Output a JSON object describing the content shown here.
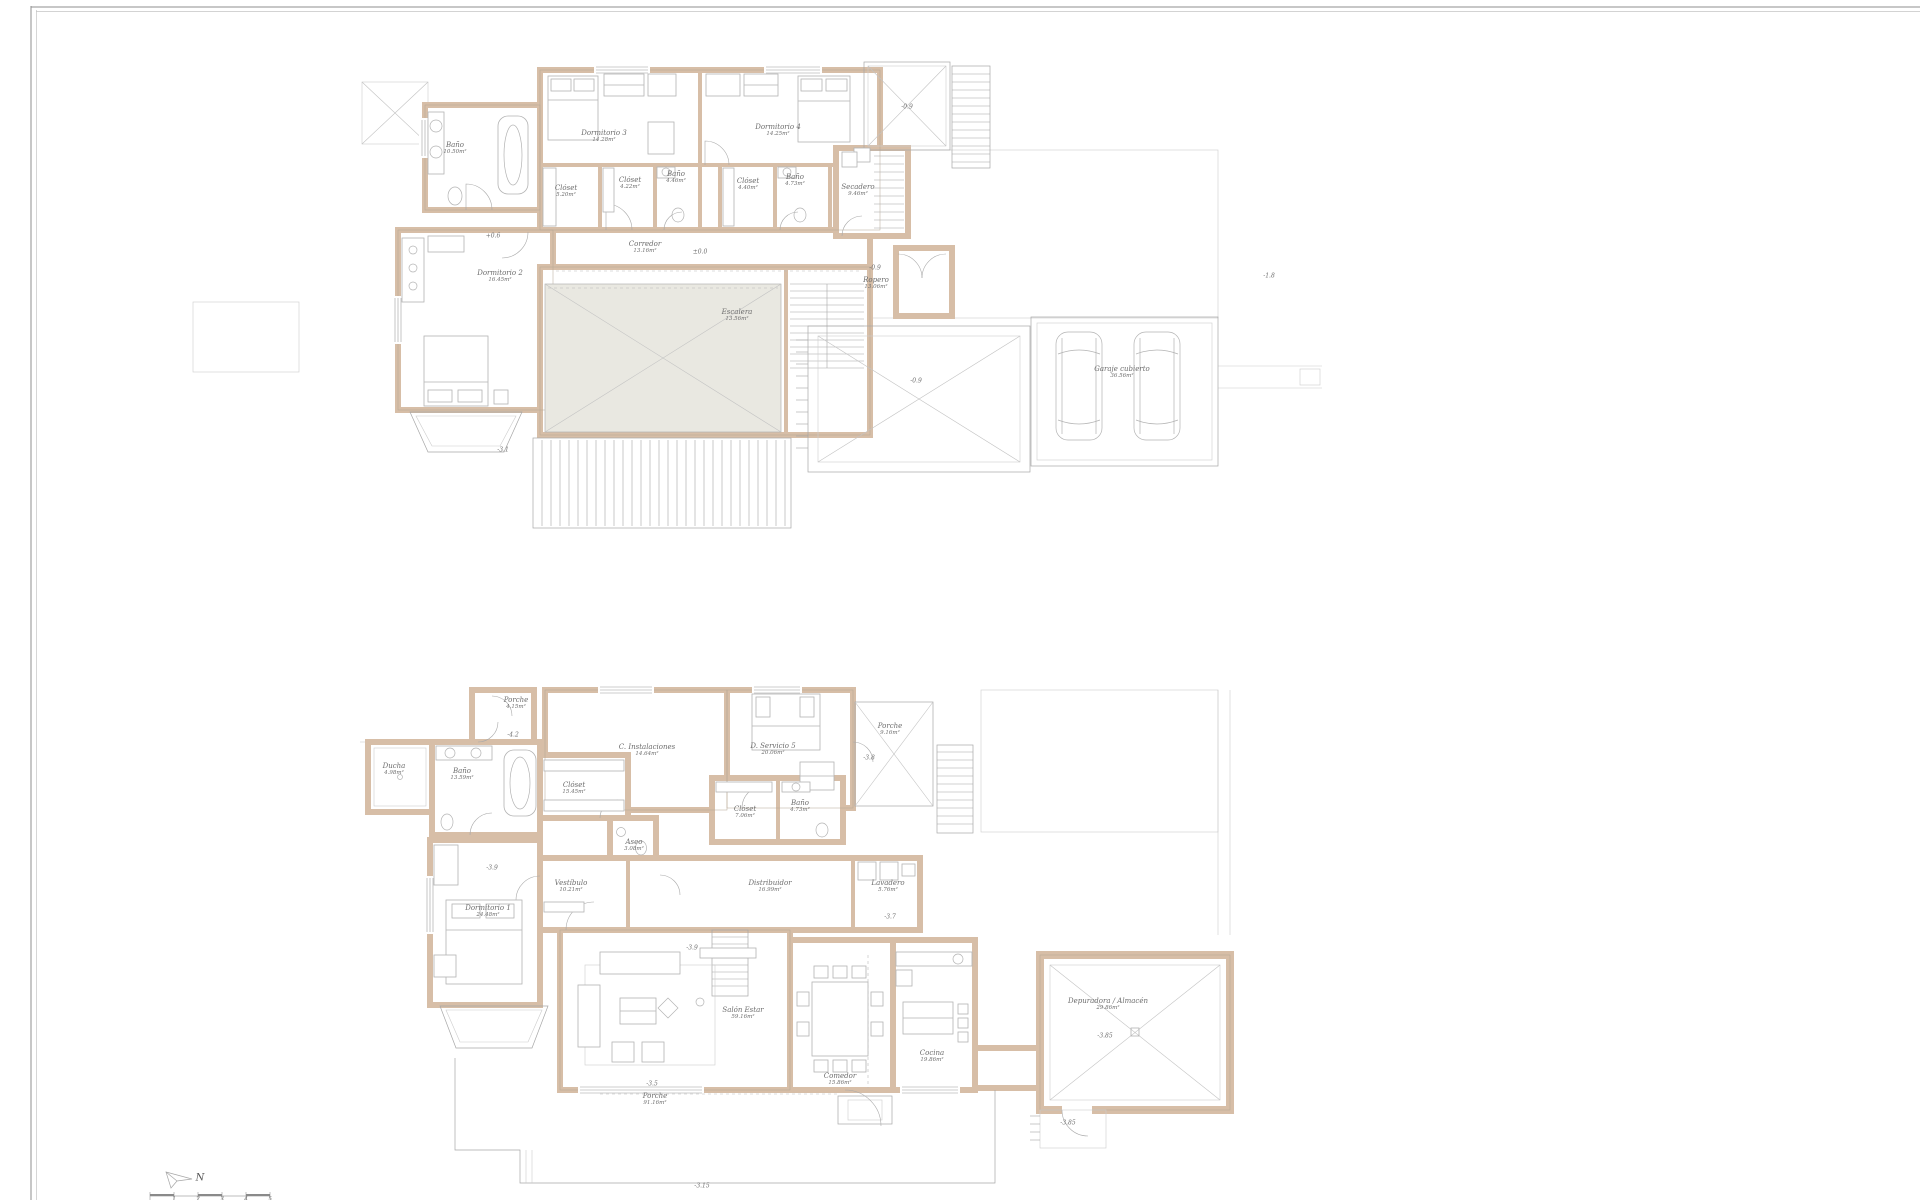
{
  "sheet": {
    "compass_north": "N",
    "scale_ticks": [
      "1",
      "2",
      "3",
      "4",
      "5"
    ]
  },
  "upper_floor": {
    "rooms": [
      {
        "name": "Dormitorio 3",
        "area": "14.28m²"
      },
      {
        "name": "Dormitorio 4",
        "area": "14.25m²"
      },
      {
        "name": "Baño",
        "area": "10.50m²"
      },
      {
        "name": "Clóset",
        "area": "5.20m²"
      },
      {
        "name": "Clóset",
        "area": "4.22m²"
      },
      {
        "name": "Baño",
        "area": "4.46m²"
      },
      {
        "name": "Clóset",
        "area": "4.40m²"
      },
      {
        "name": "Baño",
        "area": "4.73m²"
      },
      {
        "name": "Secadero",
        "area": "9.46m²"
      },
      {
        "name": "Corredor",
        "area": "13.16m²"
      },
      {
        "name": "Dormitorio 2",
        "area": "16.45m²"
      },
      {
        "name": "Escalera",
        "area": "13.56m²"
      },
      {
        "name": "Ropero",
        "area": "13.06m²"
      },
      {
        "name": "Garaje cubierto",
        "area": "36.56m²"
      }
    ],
    "levels": [
      "+0.6",
      "±0.0",
      "-0.9",
      "-0.9",
      "-0.9",
      "-1.8",
      "-3.1"
    ]
  },
  "ground_floor": {
    "rooms": [
      {
        "name": "Porche",
        "area": "4.15m²"
      },
      {
        "name": "C. Instalaciones",
        "area": "14.64m²"
      },
      {
        "name": "D. Servicio 5",
        "area": "20.06m²"
      },
      {
        "name": "Porche",
        "area": "9.16m²"
      },
      {
        "name": "Ducha",
        "area": "4.98m²"
      },
      {
        "name": "Baño",
        "area": "13.59m²"
      },
      {
        "name": "Clóset",
        "area": "15.45m²"
      },
      {
        "name": "Clóset",
        "area": "7.06m²"
      },
      {
        "name": "Baño",
        "area": "4.73m²"
      },
      {
        "name": "Aseo",
        "area": "3.08m²"
      },
      {
        "name": "Vestíbulo",
        "area": "10.21m²"
      },
      {
        "name": "Distribuidor",
        "area": "16.99m²"
      },
      {
        "name": "Lavadero",
        "area": "5.76m²"
      },
      {
        "name": "Dormitorio 1",
        "area": "24.48m²"
      },
      {
        "name": "Salón Estar",
        "area": "59.16m²"
      },
      {
        "name": "Comedor",
        "area": "15.86m²"
      },
      {
        "name": "Cocina",
        "area": "19.86m²"
      },
      {
        "name": "Depuradora / Almacén",
        "area": "29.86m²"
      },
      {
        "name": "Porche",
        "area": "91.16m²"
      }
    ],
    "levels": [
      "-4.2",
      "-3.8",
      "-3.9",
      "-3.9",
      "-3.7",
      "-3.5",
      "-3.85",
      "-3.85",
      "-3.15"
    ]
  }
}
